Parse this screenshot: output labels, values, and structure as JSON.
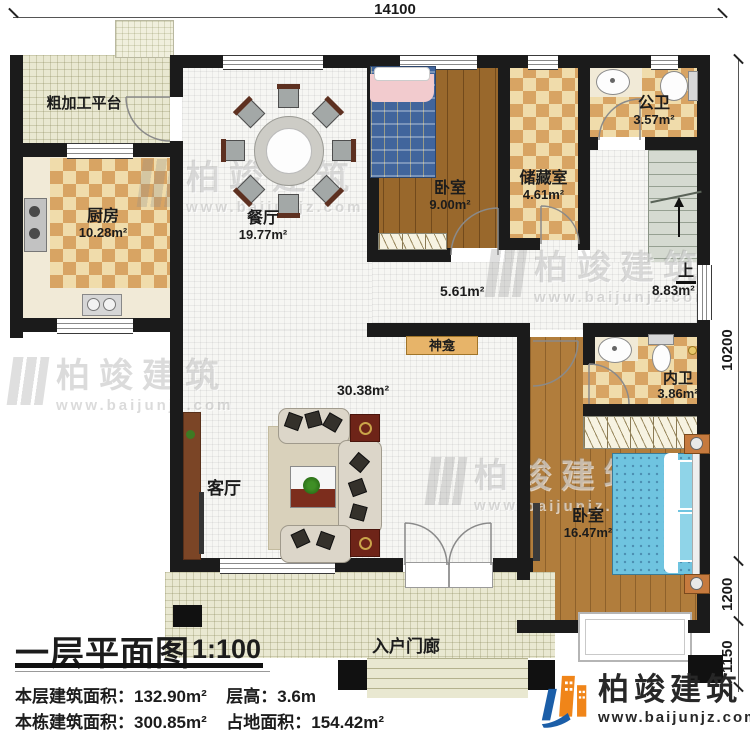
{
  "plan": {
    "dimensions": {
      "top_width": "14100",
      "right_main": "10200",
      "right_porch": "1200",
      "right_steps": "1150"
    },
    "rooms": {
      "platform": {
        "name": "粗加工平台"
      },
      "kitchen": {
        "name": "厨房",
        "area": "10.28m²"
      },
      "dining": {
        "name": "餐厅",
        "area": "19.77m²"
      },
      "bedroom_top": {
        "name": "卧室",
        "area": "9.00m²"
      },
      "storage": {
        "name": "储藏室",
        "area": "4.61m²"
      },
      "public_bath": {
        "name": "公卫",
        "area": "3.57m²"
      },
      "stairs": {
        "up_label": "上",
        "area": "8.83m²"
      },
      "corridor": {
        "area": "5.61m²"
      },
      "shrine": {
        "name": "神龛"
      },
      "living": {
        "name": "客厅",
        "area": "30.38m²"
      },
      "inner_bath": {
        "name": "内卫",
        "area": "3.86m²"
      },
      "bedroom_bottom": {
        "name": "卧室",
        "area": "16.47m²"
      },
      "porch": {
        "name": "入户门廊"
      }
    }
  },
  "title_block": {
    "title": "一层平面图",
    "scale": "1:100",
    "stats": [
      {
        "label": "本层建筑面积：",
        "value": "132.90m²"
      },
      {
        "label": "层高：",
        "value": "3.6m"
      },
      {
        "label": "本栋建筑面积：",
        "value": "300.85m²"
      },
      {
        "label": "占地面积：",
        "value": "154.42m²"
      }
    ]
  },
  "logo": {
    "company": "柏竣建筑",
    "website": "www.baijunjz.com"
  },
  "watermark": {
    "company": "柏竣建筑",
    "website": "www.baijunjz.com"
  },
  "colors": {
    "wall": "#1b1b1b",
    "brand_blue": "#1b5ea8",
    "brand_orange": "#f08519",
    "checker_dark": "#d8a463",
    "wood_dark": "#99682c",
    "wood_light": "#b17d3c"
  }
}
